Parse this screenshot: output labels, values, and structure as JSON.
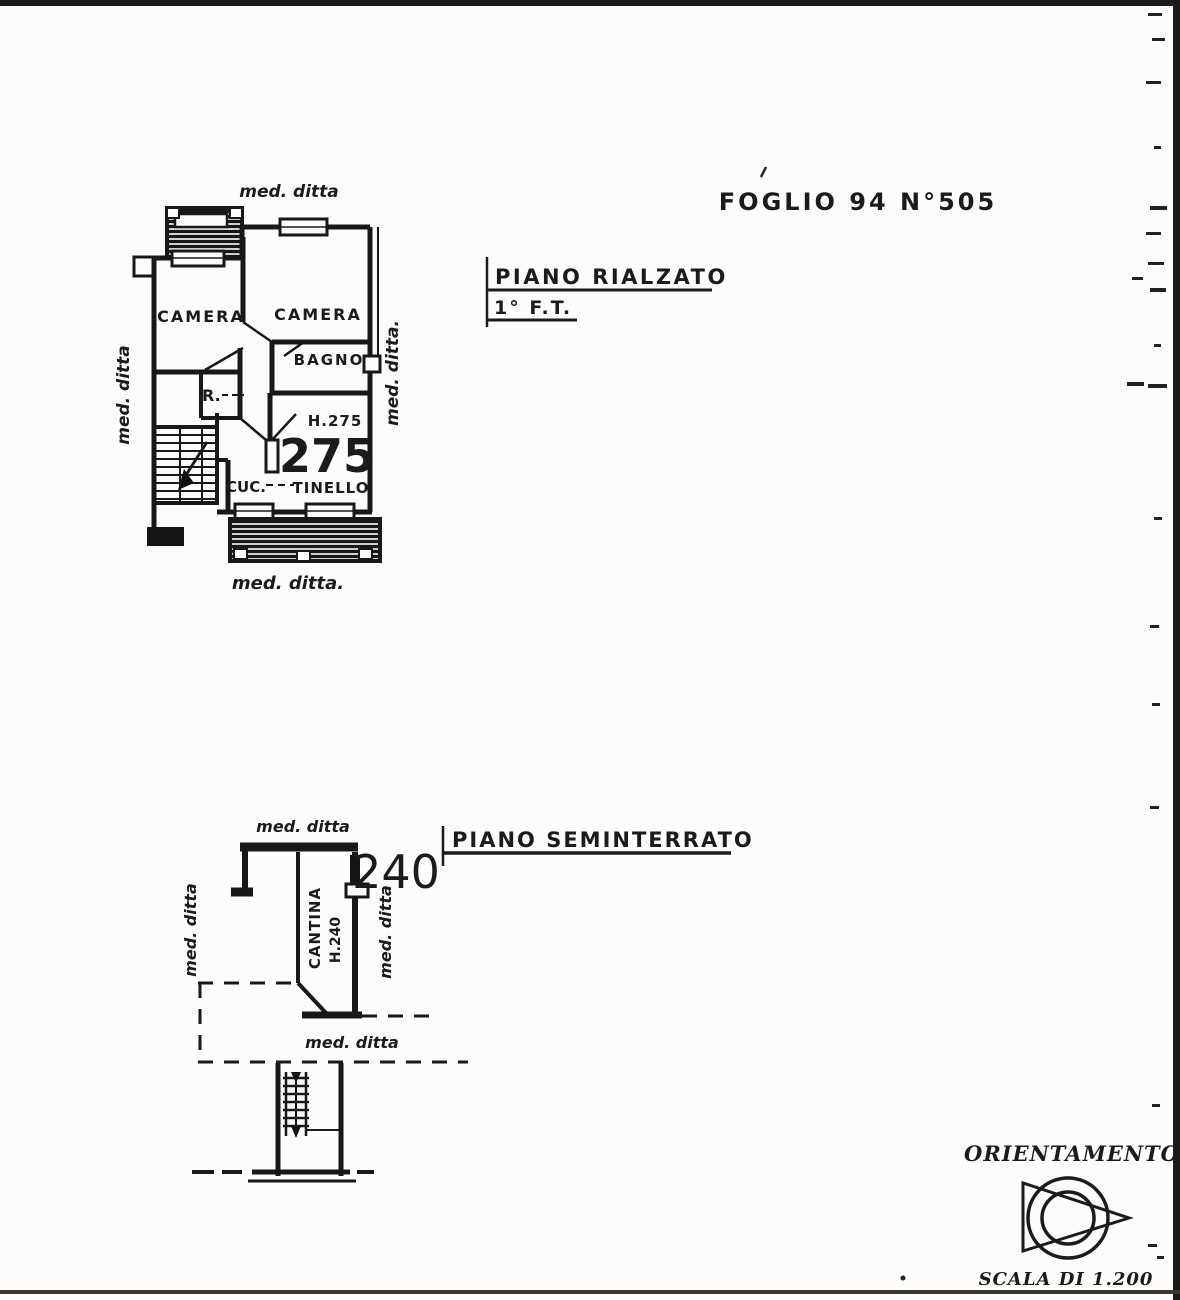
{
  "foglio": "FOGLIO 94 N°505",
  "plan1": {
    "title": "PIANO RIALZATO",
    "subtitle": "1° F.T.",
    "med_ditta_top": "med. ditta",
    "med_ditta_left": "med. ditta",
    "med_ditta_right": "med. ditta.",
    "med_ditta_bottom": "med. ditta.",
    "camera_left": "CAMERA",
    "camera_right": "CAMERA",
    "bagno": "BAGNO",
    "riser": "R.",
    "height_note": "H.275",
    "height_big": "275",
    "cucina": "CUC.",
    "tinello": "TINELLO"
  },
  "plan2": {
    "title": "PIANO SEMINTERRATO",
    "med_ditta_top": "med. ditta",
    "med_ditta_left": "med. ditta",
    "med_ditta_right": "med. ditta",
    "med_ditta_bottom": "med. ditta",
    "cantina": "CANTINA",
    "height_note": "H.240",
    "height_big": "240"
  },
  "orientation": {
    "label": "ORIENTAMENTO"
  },
  "scale_label": "SCALA DI 1.200"
}
